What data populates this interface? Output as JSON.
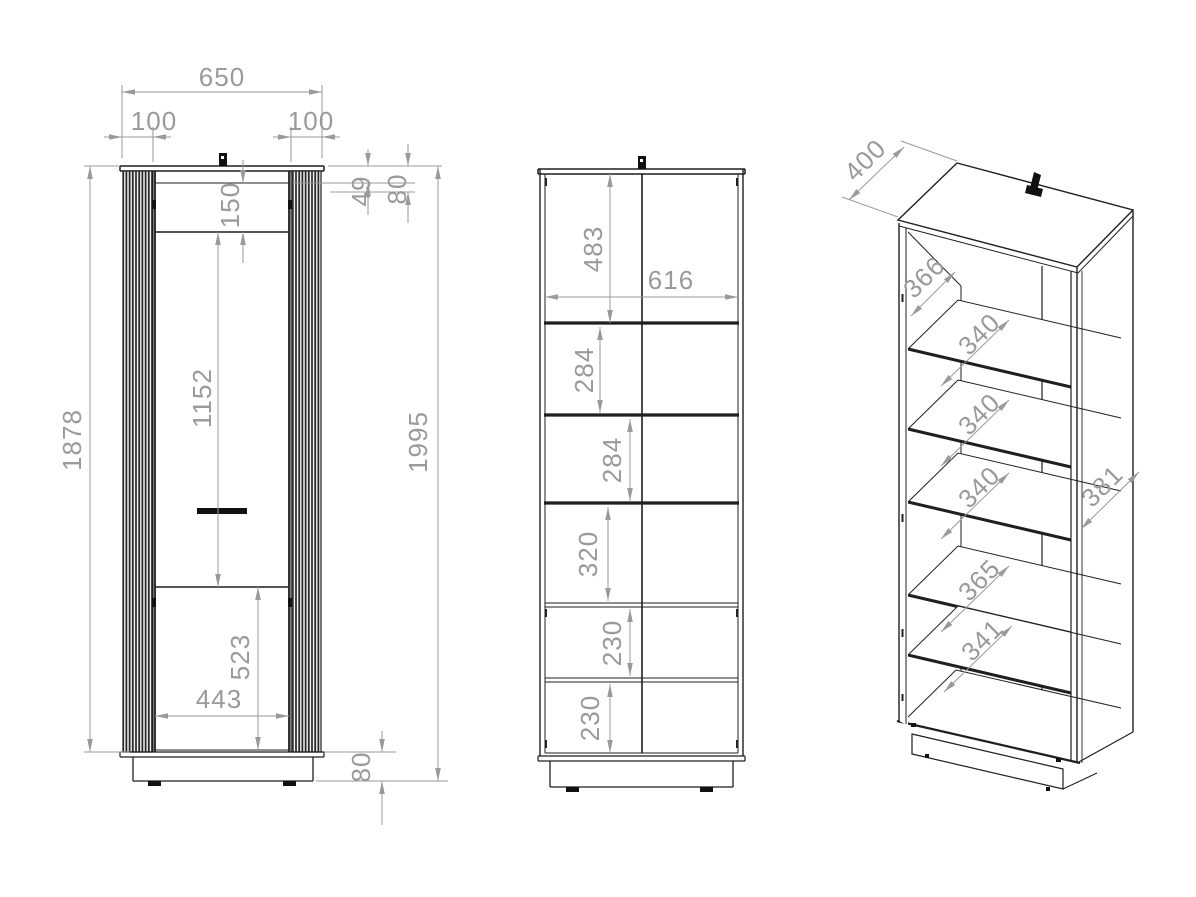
{
  "drawing": {
    "background": "#ffffff",
    "line_color": "#1f1f1f",
    "dim_color": "#9a9a9a",
    "front_view": {
      "overall_width": "650",
      "side_panel_left": "100",
      "side_panel_right": "100",
      "top_inset": "49",
      "top_section": "80",
      "door_top_gap": "150",
      "door_opening": "1152",
      "carcass_height": "1878",
      "overall_height": "1995",
      "door_width": "443",
      "bottom_section": "523",
      "plinth_height": "80"
    },
    "section_view": {
      "inner_width": "616",
      "compartments": [
        "483",
        "284",
        "284",
        "320",
        "230",
        "230"
      ]
    },
    "perspective_view": {
      "top_depth": "400",
      "interior_depth": "366",
      "shelf_depths": [
        "340",
        "340",
        "340",
        "365",
        "341"
      ],
      "side_panel_depth": "381"
    }
  }
}
